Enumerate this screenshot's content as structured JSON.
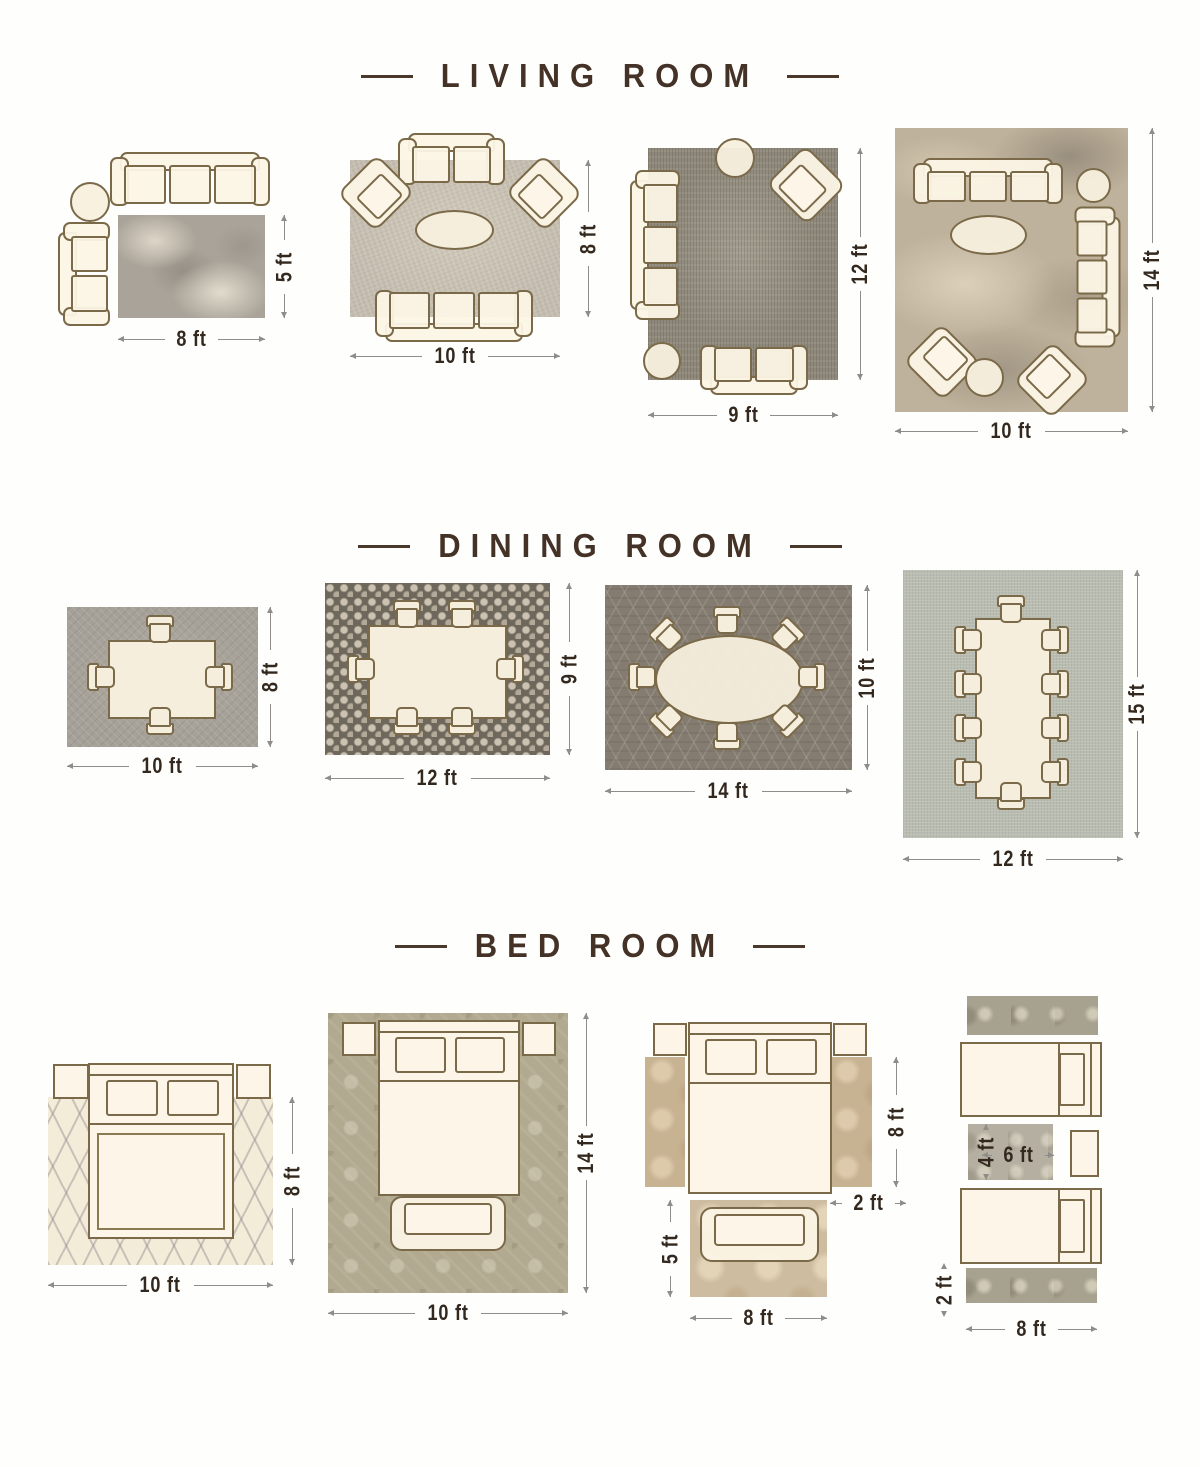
{
  "titles": {
    "living": "LIVING ROOM",
    "dining": "DINING ROOM",
    "bedroom": "BED ROOM"
  },
  "living": [
    {
      "w": "8 ft",
      "h": "5 ft"
    },
    {
      "w": "10 ft",
      "h": "8 ft"
    },
    {
      "w": "9 ft",
      "h": "12 ft"
    },
    {
      "w": "10 ft",
      "h": "14 ft"
    }
  ],
  "dining": [
    {
      "w": "10 ft",
      "h": "8 ft"
    },
    {
      "w": "12 ft",
      "h": "9 ft"
    },
    {
      "w": "14 ft",
      "h": "10 ft"
    },
    {
      "w": "12 ft",
      "h": "15 ft"
    }
  ],
  "bedroom": [
    {
      "w": "10 ft",
      "h": "8 ft"
    },
    {
      "w": "10 ft",
      "h": "14 ft"
    },
    {
      "runner_len": "8 ft",
      "runner_w": "2 ft",
      "rug_h": "5 ft",
      "rug_w": "8 ft"
    },
    {
      "rug_h": "4 ft",
      "rug_w": "6 ft",
      "runner_w": "2 ft",
      "runner_len": "8 ft"
    }
  ]
}
